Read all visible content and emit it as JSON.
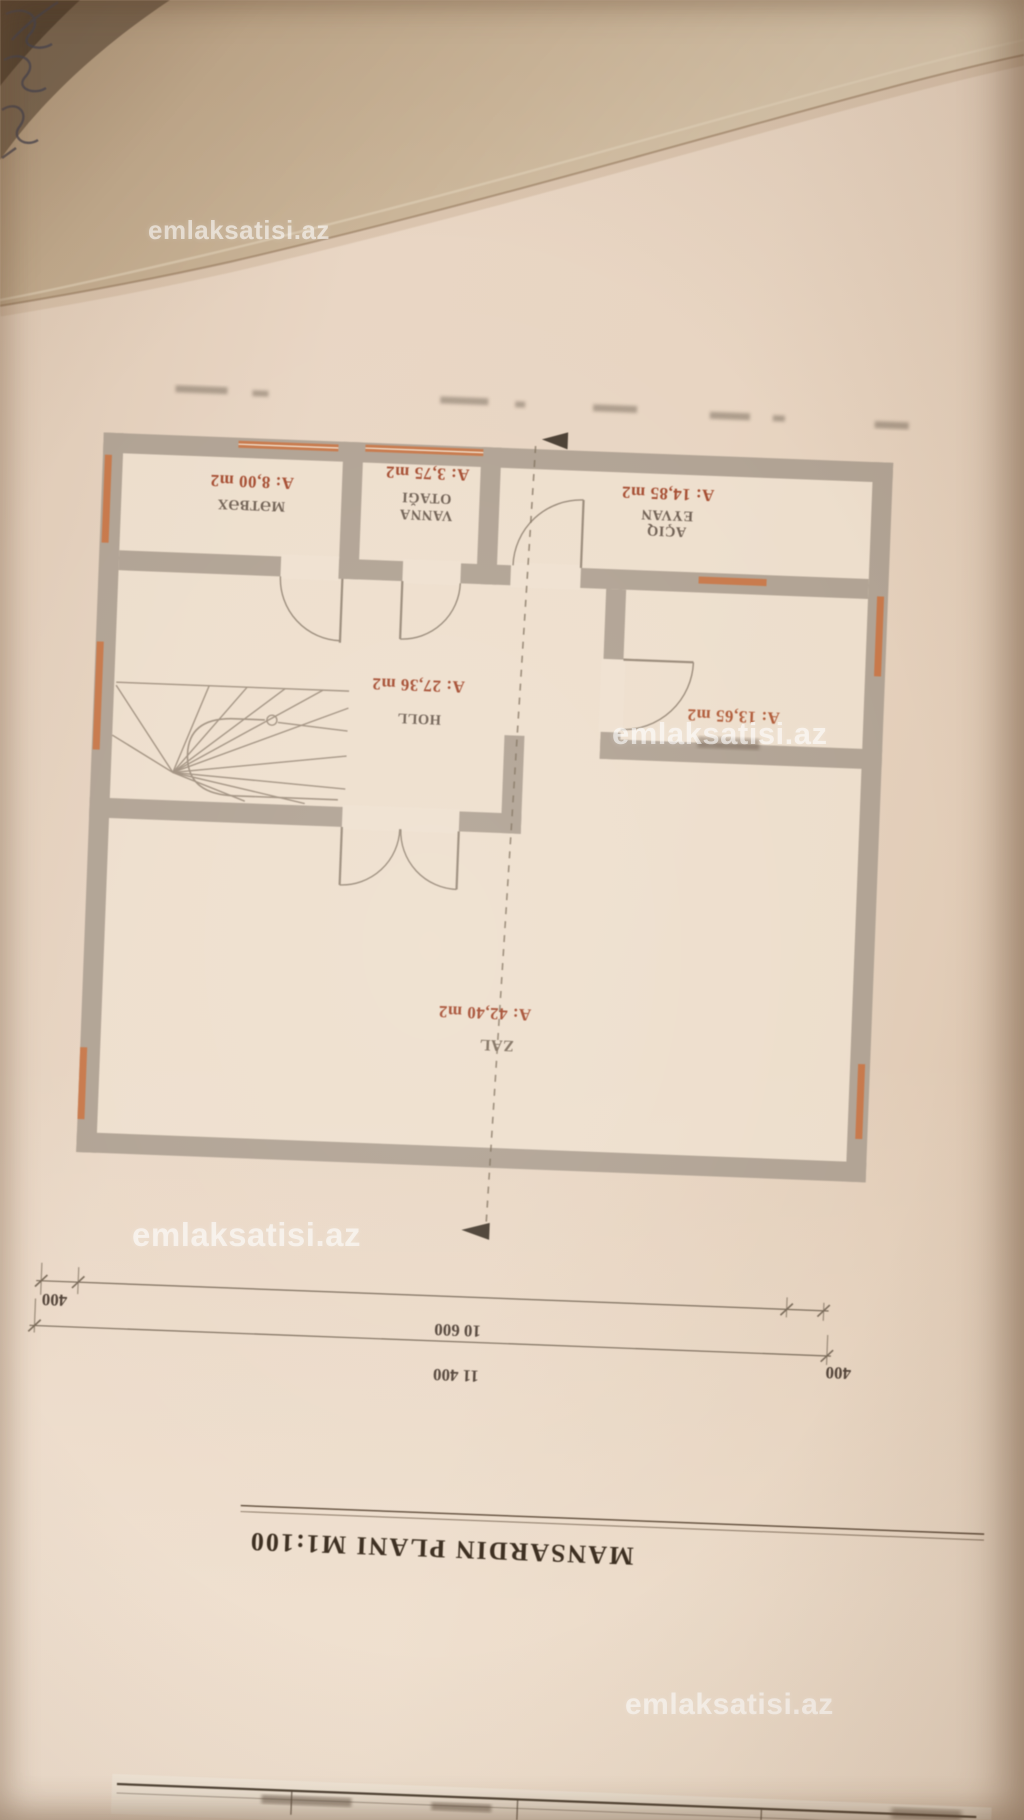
{
  "watermark": {
    "text": "emlaksatisi.az"
  },
  "plan": {
    "title": "MANSARDIN PLANI M1:100",
    "rooms": [
      {
        "name": "MƏTBƏX",
        "area": "A: 8,00 m2"
      },
      {
        "name_line1": "VANNA",
        "name_line2": "OTAĞI",
        "area": "A: 3,75 m2"
      },
      {
        "name_line1": "AÇIQ",
        "name_line2": "EYVAN",
        "area": "A: 14,85 m2"
      },
      {
        "name": "HOLL",
        "area": "A: 27,36 m2"
      },
      {
        "area": "A: 13,65 m2"
      },
      {
        "name": "ZAL",
        "area": "A: 42,40 m2"
      }
    ],
    "dimensions": {
      "left_offset": "400",
      "inner_width": "10 600",
      "total_width": "11 400",
      "right_offset": "400"
    }
  },
  "colors": {
    "wall": "#b1a394",
    "window_accent": "#c8794b",
    "area_label": "#a54c30",
    "dimension_text": "#54453a"
  }
}
